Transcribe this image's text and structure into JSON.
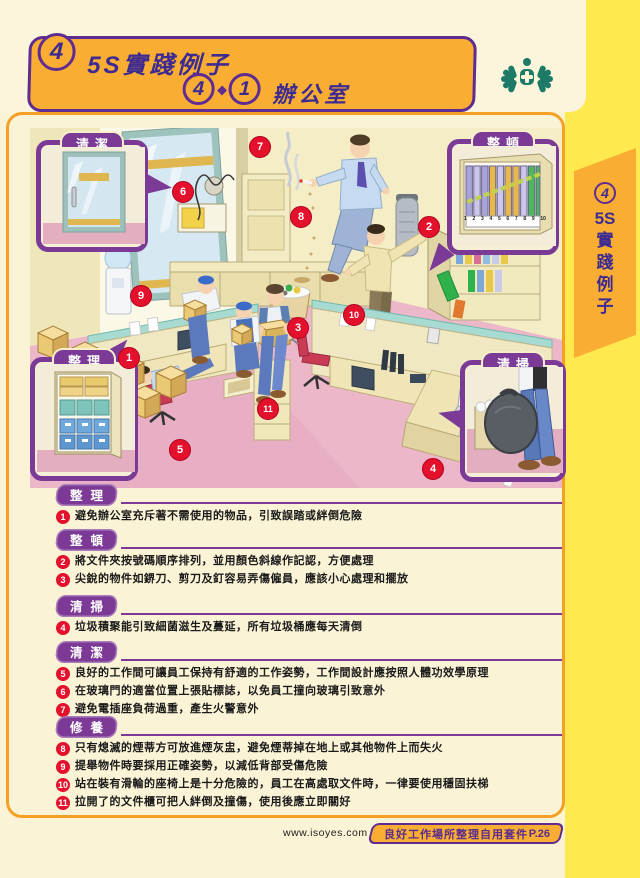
{
  "page": {
    "bg": "#FAF3D6",
    "accent_orange": "#F5A024",
    "banner_orange": "#F9AE33",
    "purple": "#5F2C91",
    "pill_purple": "#7C3996",
    "marker_red": "#E4112D",
    "yellow_strip": "#FFE94F",
    "logo_green": "#1C7A66"
  },
  "header": {
    "badge": "4",
    "title": "5S實踐例子",
    "sub_badge1": "4",
    "sub_badge2": "1",
    "subtitle": "辦公室"
  },
  "side_tab": {
    "badge": "4",
    "chars": [
      "5S",
      "實",
      "踐",
      "例",
      "子"
    ]
  },
  "callouts": {
    "clean": {
      "label": "清潔"
    },
    "tidy": {
      "label": "整頓",
      "binder_numbers": [
        "1",
        "2",
        "3",
        "4",
        "5",
        "6",
        "7",
        "8",
        "9",
        "10"
      ]
    },
    "sort": {
      "label": "整理"
    },
    "sweep": {
      "label": "清掃"
    }
  },
  "markers": [
    {
      "label": "1"
    },
    {
      "label": "2"
    },
    {
      "label": "3"
    },
    {
      "label": "4"
    },
    {
      "label": "5"
    },
    {
      "label": "6"
    },
    {
      "label": "7"
    },
    {
      "label": "8"
    },
    {
      "label": "9"
    },
    {
      "label": "10"
    },
    {
      "label": "11"
    }
  ],
  "sections": [
    {
      "title": "整理",
      "items": [
        {
          "num": "1",
          "text": "避免辦公室充斥著不需使用的物品，引致誤踏或絆倒危險"
        }
      ]
    },
    {
      "title": "整頓",
      "items": [
        {
          "num": "2",
          "text": "將文件夾按號碼順序排列，並用顏色斜線作記認，方便處理"
        },
        {
          "num": "3",
          "text": "尖銳的物件如鎅刀、剪刀及釘容易弄傷僱員，應該小心處理和擺放"
        }
      ]
    },
    {
      "title": "清掃",
      "items": [
        {
          "num": "4",
          "text": "垃圾積聚能引致細菌滋生及蔓延，所有垃圾桶應每天清倒"
        }
      ]
    },
    {
      "title": "清潔",
      "items": [
        {
          "num": "5",
          "text": "良好的工作間可讓員工保持有舒適的工作姿勢，工作間設計應按照人體功效學原理"
        },
        {
          "num": "6",
          "text": "在玻璃門的適當位置上張貼標誌，以免員工撞向玻璃引致意外"
        },
        {
          "num": "7",
          "text": "避免電插座負荷過重，產生火警意外"
        }
      ]
    },
    {
      "title": "修養",
      "items": [
        {
          "num": "8",
          "text": "只有熄滅的煙蒂方可放進煙灰盅，避免煙蒂掉在地上或其他物件上而失火"
        },
        {
          "num": "9",
          "text": "提舉物件時要採用正確姿勢，以減低背部受傷危險"
        },
        {
          "num": "10",
          "text": "站在裝有滑輪的座椅上是十分危險的，員工在高處取文件時，一律要使用穩固扶梯"
        },
        {
          "num": "11",
          "text": "拉開了的文件櫃可把人絆倒及撞傷，使用後應立即關好"
        }
      ]
    }
  ],
  "footer": {
    "url": "www.isoyes.com",
    "kit_title": "良好工作場所整理自用套件",
    "page_no": "P.26"
  }
}
